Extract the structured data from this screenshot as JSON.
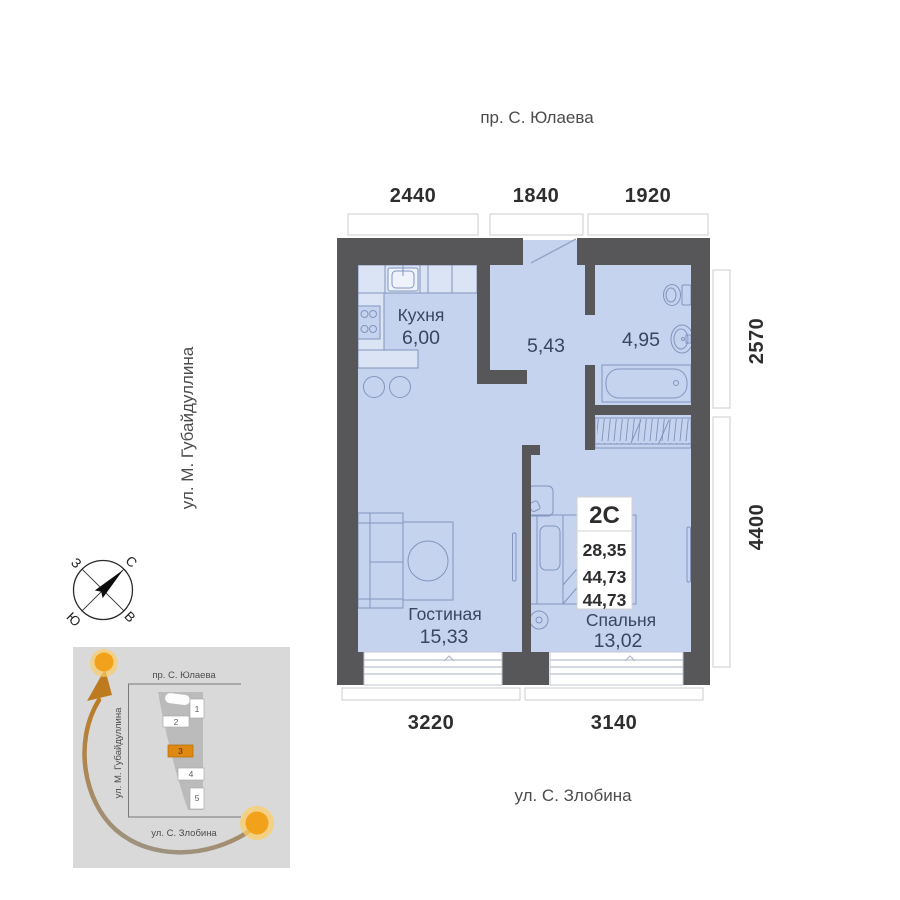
{
  "streets": {
    "top": "пр. С. Юлаева",
    "left": "ул. М. Губайдуллина",
    "bottom": "ул. С. Злобина"
  },
  "dimensions": {
    "top": [
      "2440",
      "1840",
      "1920"
    ],
    "right": [
      "2570",
      "4400"
    ],
    "bottom": [
      "3220",
      "3140"
    ]
  },
  "rooms": {
    "kitchen": {
      "label": "Кухня",
      "area": "6,00"
    },
    "hallway": {
      "area": "5,43"
    },
    "bathroom": {
      "area": "4,95"
    },
    "living": {
      "label": "Гостиная",
      "area": "15,33"
    },
    "bedroom": {
      "label": "Спальня",
      "area": "13,02"
    }
  },
  "apartment_card": {
    "type": "2С",
    "values": [
      "28,35",
      "44,73",
      "44,73"
    ]
  },
  "compass": {
    "north": "С",
    "east": "В",
    "south": "Ю",
    "west": "З"
  },
  "minimap": {
    "streets": {
      "top": "пр. С. Юлаева",
      "left": "ул. М. Губайдуллина",
      "bottom": "ул. С. Злобина"
    },
    "buildings": [
      "1",
      "2",
      "3",
      "4",
      "5"
    ],
    "highlighted_building": "3"
  },
  "colors": {
    "floor": "#c6d3ee",
    "wall": "#57575a",
    "accent": "#e08912",
    "furniture_line": "#8295bf",
    "sun": "#f2a11b"
  }
}
